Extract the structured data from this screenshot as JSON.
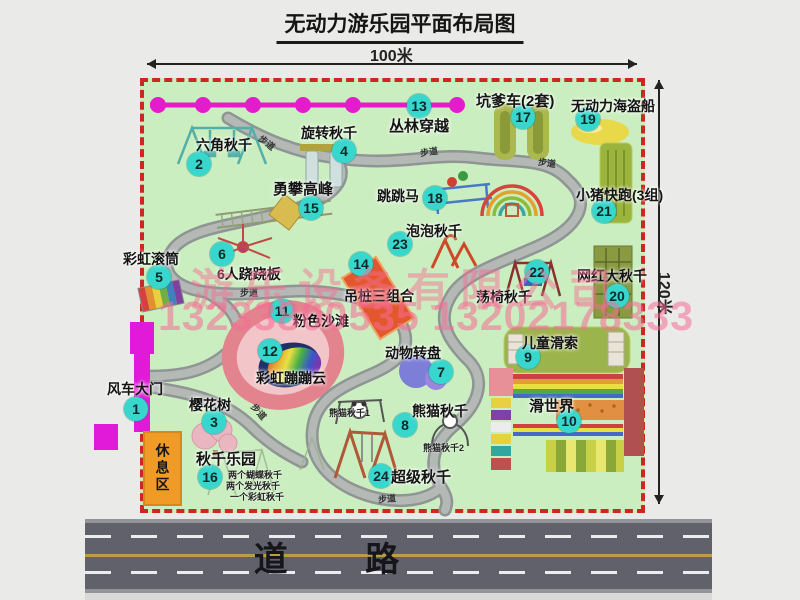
{
  "title": "无动力游乐园平面布局图",
  "dimension_labels": {
    "top": "100米",
    "right": "120米"
  },
  "road_label": "道 路",
  "rest_area_label": "休息区",
  "walkway_label": "步道",
  "watermark": {
    "company": "游乐设备有限公司",
    "phone": "13233800535 13202178333"
  },
  "attractions": [
    {
      "id": 1,
      "name": "风车大门"
    },
    {
      "id": 2,
      "name": "六角秋千"
    },
    {
      "id": 3,
      "name": "樱花树"
    },
    {
      "id": 4,
      "name": "旋转秋千"
    },
    {
      "id": 5,
      "name": "彩虹滚筒"
    },
    {
      "id": 6,
      "name": "6人跷跷板"
    },
    {
      "id": 7,
      "name": "动物转盘"
    },
    {
      "id": 8,
      "name": "熊猫秋千"
    },
    {
      "id": 9,
      "name": "儿童滑索"
    },
    {
      "id": 10,
      "name": "滑世界"
    },
    {
      "id": 11,
      "name": "粉色沙滩"
    },
    {
      "id": 12,
      "name": "彩虹蹦蹦云"
    },
    {
      "id": 13,
      "name": "丛林穿越"
    },
    {
      "id": 14,
      "name": "吊桩三组合"
    },
    {
      "id": 15,
      "name": "勇攀高峰"
    },
    {
      "id": 16,
      "name": "秋千乐园",
      "notes": [
        "两个蝴蝶秋千",
        "两个发光秋千",
        "一个彩虹秋千"
      ]
    },
    {
      "id": 17,
      "name": "坑爹车(2套)"
    },
    {
      "id": 18,
      "name": "跳跳马"
    },
    {
      "id": 19,
      "name": "无动力海盗船"
    },
    {
      "id": 20,
      "name": "网红大秋千"
    },
    {
      "id": 21,
      "name": "小猪快跑(3组)"
    },
    {
      "id": 22,
      "name": "荡椅秋千"
    },
    {
      "id": 23,
      "name": "泡泡秋千"
    },
    {
      "id": 24,
      "name": "超级秋千"
    }
  ],
  "panda_swing_sublabels": [
    "熊猫秋千1",
    "熊猫秋千2"
  ],
  "colors": {
    "map_bg": "#cbeec0",
    "border_dash": "#cd271f",
    "badge": "#38d7cd",
    "zipline": "#e41ccc",
    "gate": "#e01ad8",
    "rest_area": "#f09a28",
    "road": "#61616b",
    "watermark": "#f66c94",
    "path": "#9aa09e"
  }
}
